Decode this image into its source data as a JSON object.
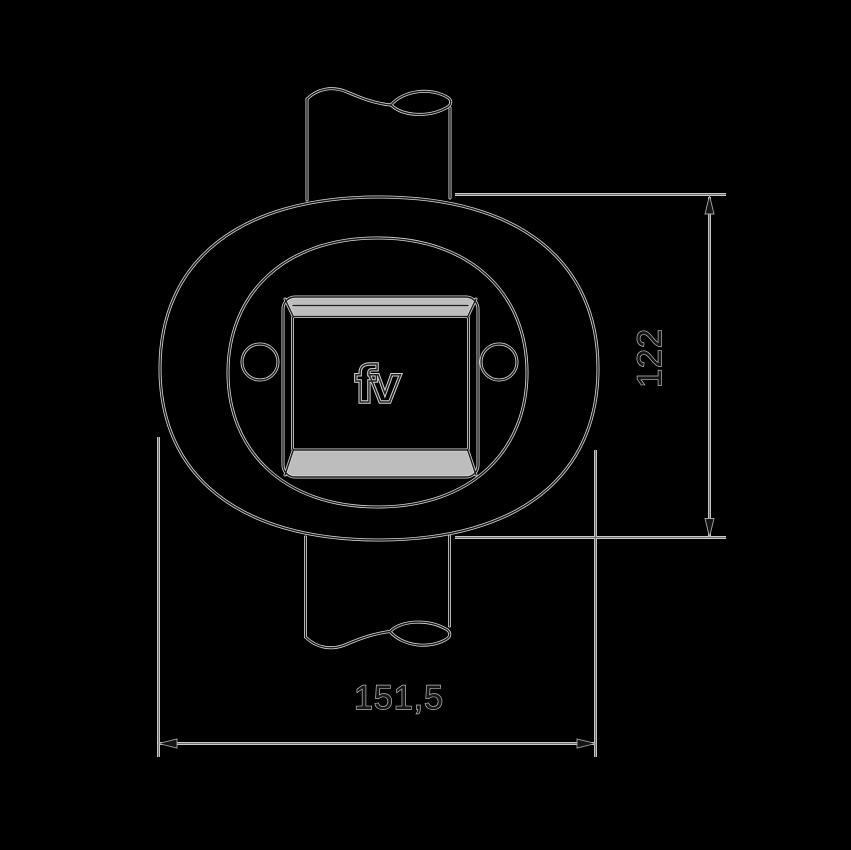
{
  "drawing": {
    "logo_text": "fv",
    "dimension_height_label": "122",
    "dimension_width_label": "151,5",
    "colors": {
      "background": "#000000",
      "outline_core": "#1c1c1c",
      "outline_halo": "#d9d9d9",
      "dimension_line": "#c9c9c9",
      "dimension_text": "#161616",
      "chamfer_fill": "#bdbdbd"
    }
  }
}
